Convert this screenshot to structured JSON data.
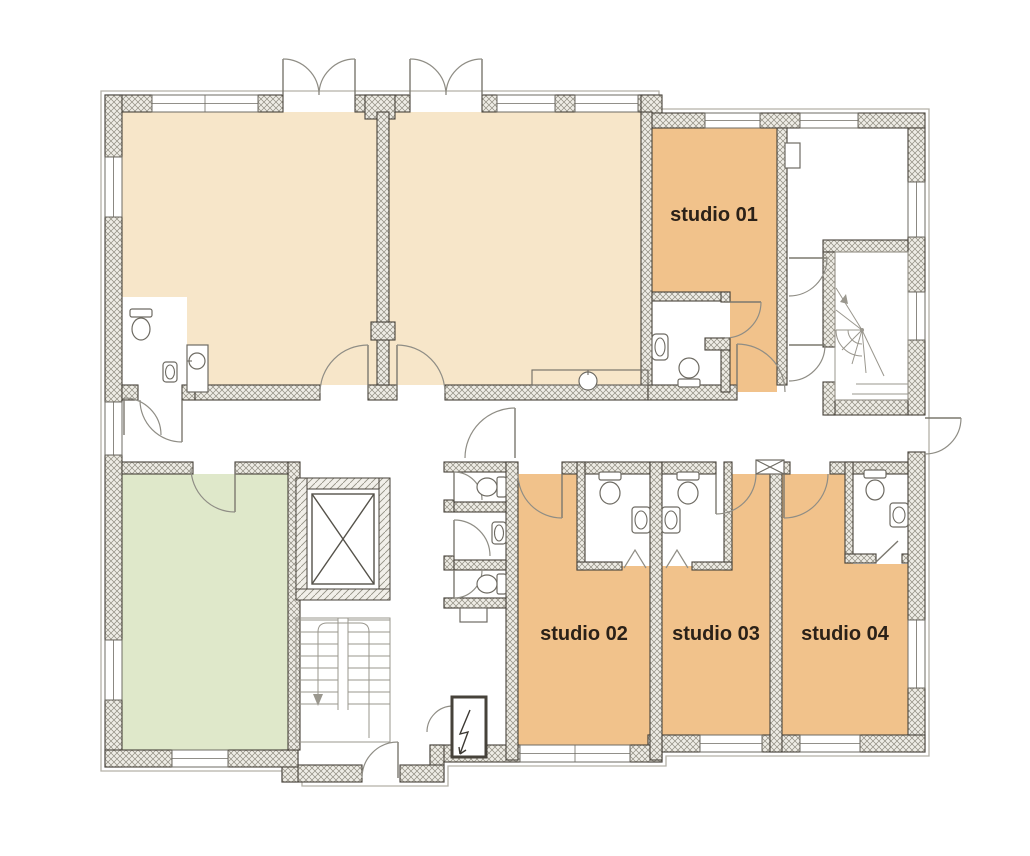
{
  "plan": {
    "rooms": [
      {
        "id": "studio-01",
        "label": "studio 01"
      },
      {
        "id": "studio-02",
        "label": "studio 02"
      },
      {
        "id": "studio-03",
        "label": "studio 03"
      },
      {
        "id": "studio-04",
        "label": "studio 04"
      }
    ],
    "colors": {
      "cream": "#f7e6c9",
      "orange": "#f1c28b",
      "green": "#dfe8ca",
      "label": "#2b2118",
      "wall_stroke": "#46423a",
      "thin_line": "#8f8d85",
      "background": "#ffffff"
    }
  }
}
